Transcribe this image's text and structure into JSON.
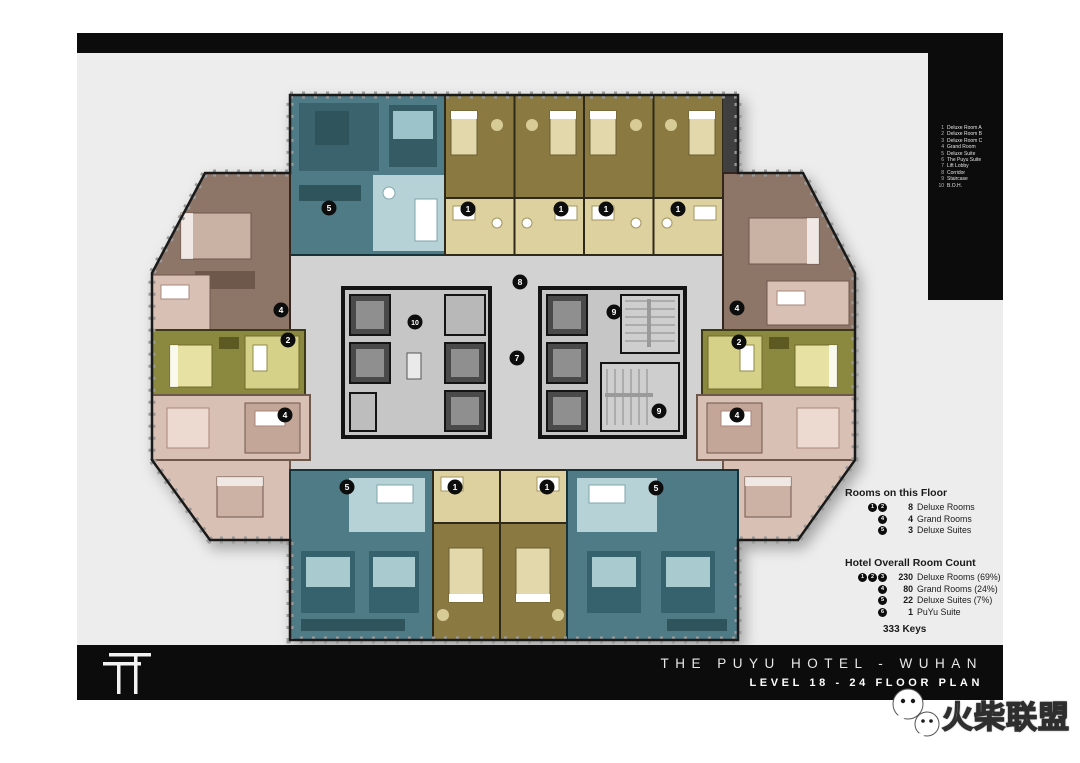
{
  "legend": {
    "items": [
      {
        "n": "1",
        "label": "Deluxe Room A"
      },
      {
        "n": "2",
        "label": "Deluxe Room B"
      },
      {
        "n": "3",
        "label": "Deluxe Room C"
      },
      {
        "n": "4",
        "label": "Grand Room"
      },
      {
        "n": "5",
        "label": "Deluxe Suite"
      },
      {
        "n": "6",
        "label": "The Puyu Suite"
      },
      {
        "n": "7",
        "label": "Lift Lobby"
      },
      {
        "n": "8",
        "label": "Corridor"
      },
      {
        "n": "9",
        "label": "Staircase"
      },
      {
        "n": "10",
        "label": "B.O.H."
      }
    ]
  },
  "floor_stats": {
    "title": "Rooms on this Floor",
    "rows": [
      {
        "badges": [
          "1",
          "2"
        ],
        "count": "8",
        "label": "Deluxe Rooms"
      },
      {
        "badges": [
          "4"
        ],
        "count": "4",
        "label": "Grand Rooms"
      },
      {
        "badges": [
          "5"
        ],
        "count": "3",
        "label": "Deluxe Suites"
      }
    ]
  },
  "hotel_stats": {
    "title": "Hotel Overall Room Count",
    "rows": [
      {
        "badges": [
          "1",
          "2",
          "3"
        ],
        "count": "230",
        "label": "Deluxe Rooms (69%)"
      },
      {
        "badges": [
          "4"
        ],
        "count": "80",
        "label": "Grand Rooms (24%)"
      },
      {
        "badges": [
          "5"
        ],
        "count": "22",
        "label": "Deluxe Suites (7%)"
      },
      {
        "badges": [
          "6"
        ],
        "count": "1",
        "label": "PuYu Suite"
      }
    ],
    "total": "333 Keys"
  },
  "title_block": {
    "line1": "THE PUYU HOTEL - WUHAN",
    "line2": "LEVEL 18 - 24 FLOOR PLAN"
  },
  "watermark": {
    "text": "火柴联盟"
  },
  "plan": {
    "markers": [
      {
        "n": "5"
      },
      {
        "n": "1"
      },
      {
        "n": "1"
      },
      {
        "n": "1"
      },
      {
        "n": "1"
      },
      {
        "n": "8"
      },
      {
        "n": "10"
      },
      {
        "n": "7"
      },
      {
        "n": "9"
      },
      {
        "n": "9"
      },
      {
        "n": "4"
      },
      {
        "n": "2"
      },
      {
        "n": "4"
      },
      {
        "n": "4"
      },
      {
        "n": "2"
      },
      {
        "n": "4"
      },
      {
        "n": "5"
      },
      {
        "n": "1"
      },
      {
        "n": "1"
      },
      {
        "n": "5"
      }
    ]
  },
  "colors": {
    "canvas": "#ededed",
    "bar_black": "#0c0c0c",
    "corridor": "#d2d2d2",
    "gold_dark": "#8a7a42",
    "gold_pale": "#ded1a0",
    "teal": "#4e7b85",
    "teal_light": "#b6d2d6",
    "brown": "#8d7668",
    "pink": "#d9c0b4",
    "olive": "#8b8840",
    "olive_light": "#d6d189",
    "core_gray": "#c6c6c6",
    "lift_dark": "#4a4a4a"
  }
}
